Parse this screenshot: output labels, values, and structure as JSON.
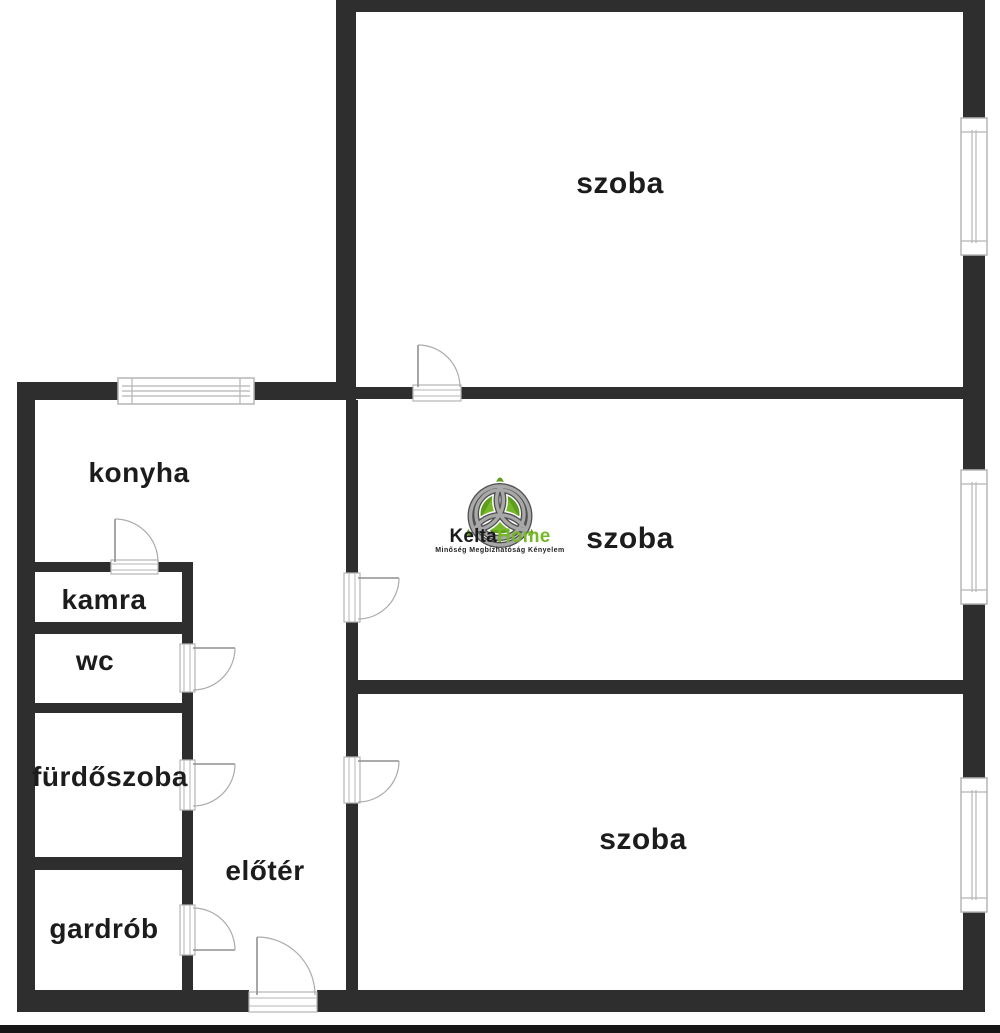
{
  "plan": {
    "rooms": [
      {
        "id": "szoba-top",
        "label": "szoba"
      },
      {
        "id": "szoba-middle",
        "label": "szoba"
      },
      {
        "id": "szoba-bottom",
        "label": "szoba"
      },
      {
        "id": "konyha",
        "label": "konyha"
      },
      {
        "id": "kamra",
        "label": "kamra"
      },
      {
        "id": "wc",
        "label": "wc"
      },
      {
        "id": "furdoszoba",
        "label": "fürdőszoba"
      },
      {
        "id": "eloter",
        "label": "előtér"
      },
      {
        "id": "gardrob",
        "label": "gardrób"
      }
    ]
  },
  "logo": {
    "brand_black": "Kelta",
    "brand_green": "Home",
    "tagline": "Minőség Megbízhatóság Kényelem",
    "green": "#76b82a",
    "knot_gray": "#a8a8a8"
  },
  "colors": {
    "wall": "#2e2e2e",
    "frame_line": "#b5b5b5",
    "door_line": "#9a9a9a",
    "label": "#1c1c1c",
    "bottom_bar": "#161616"
  }
}
